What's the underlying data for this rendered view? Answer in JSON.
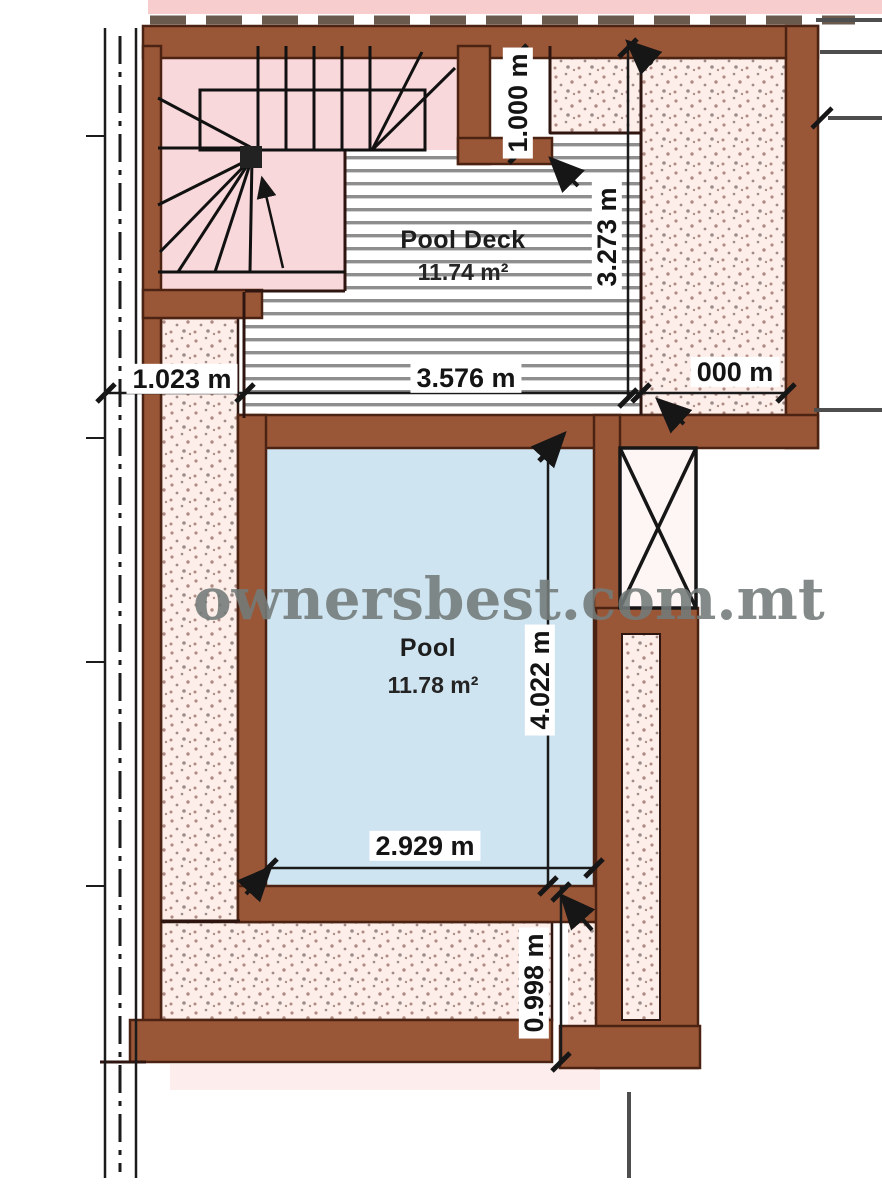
{
  "plan": {
    "watermark": "ownersbest.com.mt",
    "rooms": {
      "pool_deck": {
        "name": "Pool Deck",
        "area": "11.74 m²"
      },
      "pool": {
        "name": "Pool",
        "area": "11.78 m²"
      }
    },
    "dimensions": {
      "niche_top_v": "1.000 m",
      "deck_height_v": "3.273 m",
      "left_width": "1.023 m",
      "deck_width": "3.576 m",
      "right_width": "000 m",
      "pool_height_v": "4.022 m",
      "pool_width": "2.929 m",
      "bottom_height_v": "0.998 m"
    },
    "colors": {
      "wall_brown": "#9a5738",
      "wall_outline": "#4c2213",
      "pool_blue": "#cfe4f1",
      "stipple_pink": "#fdeeea",
      "stair_pink": "#f8d8da",
      "watermark_grey": "#737b79",
      "deck_stripe_grey": "#8e8e8e"
    }
  }
}
